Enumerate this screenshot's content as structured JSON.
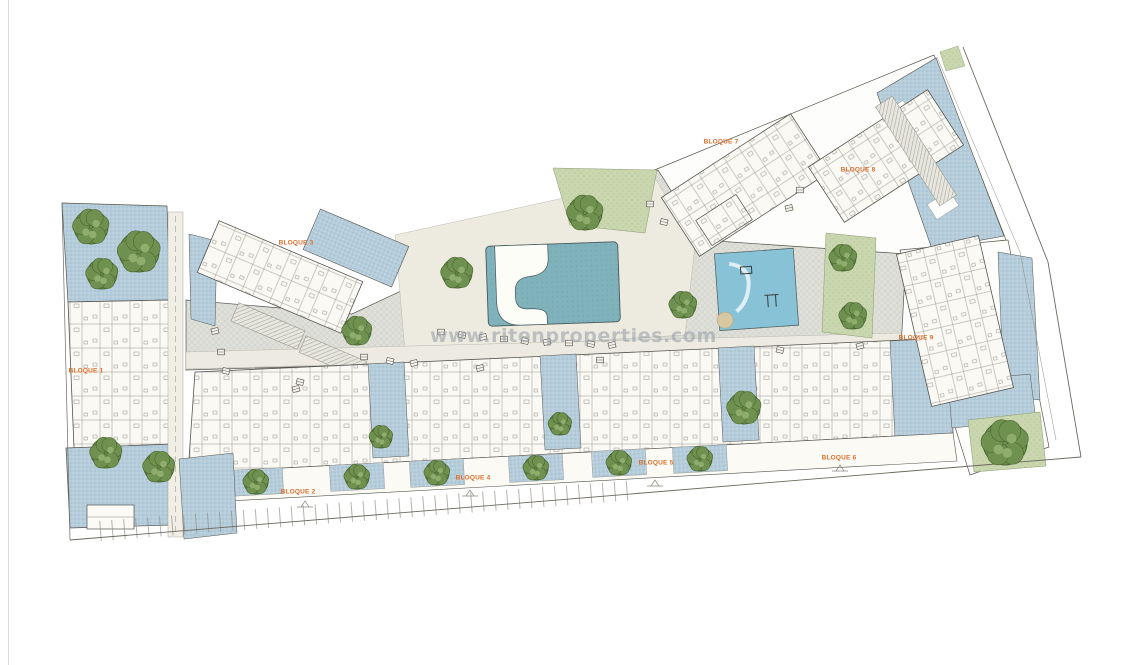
{
  "image": {
    "type": "architectural-site-plan",
    "background": "#ffffff"
  },
  "watermark": {
    "text": "www.ritenproperties.com",
    "color": "#99a1ab"
  },
  "plan": {
    "label_color": "#de6f2c",
    "block_labels": [
      {
        "label": "BLOQUE 1",
        "x": 86,
        "y": 371
      },
      {
        "label": "BLOQUE 2",
        "x": 298,
        "y": 492
      },
      {
        "label": "BLOQUE 3",
        "x": 296,
        "y": 243
      },
      {
        "label": "BLOQUE 4",
        "x": 473,
        "y": 478
      },
      {
        "label": "BLOQUE 5",
        "x": 656,
        "y": 463
      },
      {
        "label": "BLOQUE 6",
        "x": 839,
        "y": 458
      },
      {
        "label": "BLOQUE 7",
        "x": 721,
        "y": 142
      },
      {
        "label": "BLOQUE 8",
        "x": 858,
        "y": 170
      },
      {
        "label": "BLOQUE 9",
        "x": 916,
        "y": 338
      }
    ],
    "colors": {
      "canopy": "#6f9150",
      "canopy_dark": "#4a662f",
      "canopy_light": "#8fae6e",
      "water": "#80b2bc",
      "playground": "#87c2d6",
      "hatch_blue": "#b5ccdb",
      "ground_green": "#c9d6ae",
      "paving_gray": "#dedfd8",
      "outline": "#55544e"
    },
    "trees": [
      [
        91,
        227,
        17
      ],
      [
        139,
        252,
        20
      ],
      [
        102,
        274,
        15
      ],
      [
        106,
        453,
        15
      ],
      [
        159,
        467,
        15
      ],
      [
        585,
        213,
        17
      ],
      [
        457,
        273,
        15
      ],
      [
        357,
        331,
        14
      ],
      [
        683,
        305,
        13
      ],
      [
        744,
        408,
        16
      ],
      [
        843,
        258,
        13
      ],
      [
        853,
        316,
        13
      ],
      [
        381,
        437,
        11
      ],
      [
        560,
        424,
        11
      ],
      [
        256,
        482,
        12
      ],
      [
        357,
        477,
        12
      ],
      [
        437,
        473,
        12
      ],
      [
        536,
        468,
        12
      ],
      [
        619,
        463,
        12
      ],
      [
        700,
        459,
        12
      ],
      [
        1005,
        443,
        22
      ]
    ],
    "furniture": [
      [
        215,
        331
      ],
      [
        221,
        352
      ],
      [
        226,
        371
      ],
      [
        296,
        389
      ],
      [
        364,
        357
      ],
      [
        390,
        361
      ],
      [
        414,
        363
      ],
      [
        441,
        332
      ],
      [
        462,
        335
      ],
      [
        483,
        337
      ],
      [
        504,
        339
      ],
      [
        525,
        341
      ],
      [
        547,
        342
      ],
      [
        569,
        343
      ],
      [
        591,
        344
      ],
      [
        612,
        345
      ],
      [
        650,
        204
      ],
      [
        664,
        222
      ],
      [
        789,
        208
      ],
      [
        800,
        190
      ],
      [
        300,
        382
      ],
      [
        480,
        368
      ],
      [
        600,
        360
      ],
      [
        780,
        350
      ],
      [
        860,
        346
      ]
    ]
  }
}
